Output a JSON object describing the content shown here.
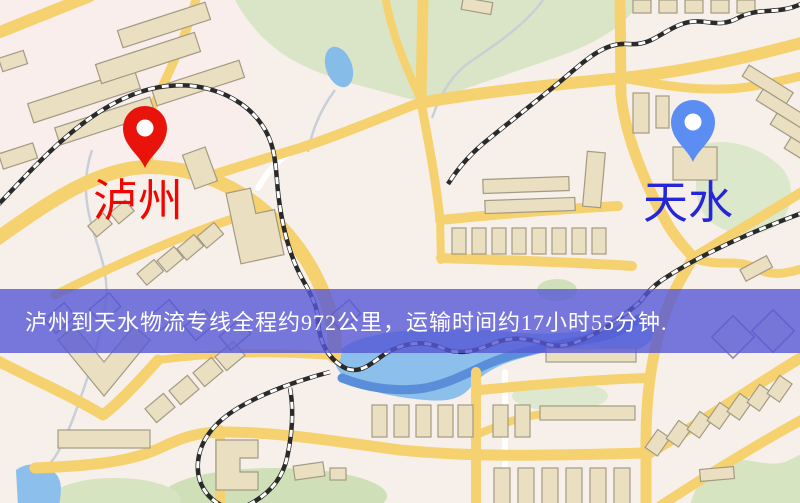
{
  "map": {
    "markers": [
      {
        "id": "luzhou",
        "label": "泸州",
        "label_color": "#f20500",
        "pin_color": "#e8140c",
        "pin_hole_color": "#ffffff"
      },
      {
        "id": "tianshui",
        "label": "天水",
        "label_color": "#2626d9",
        "pin_color": "#5b8df2",
        "pin_hole_color": "#ffffff"
      }
    ],
    "banner": {
      "text": "泸州到天水物流专线全程约972公里，运输时间约17小时55分钟.",
      "bg": "rgba(86,88,215,0.80)",
      "text_color": "#ffffff"
    },
    "palette": {
      "base": "#f7f0ea",
      "road_major": "#f5d26f",
      "road_minor": "#ffffff",
      "park": "#d9e5c6",
      "water": "#8cbfec",
      "building": "#eadfc1",
      "railway": "#2a2a2a"
    }
  }
}
